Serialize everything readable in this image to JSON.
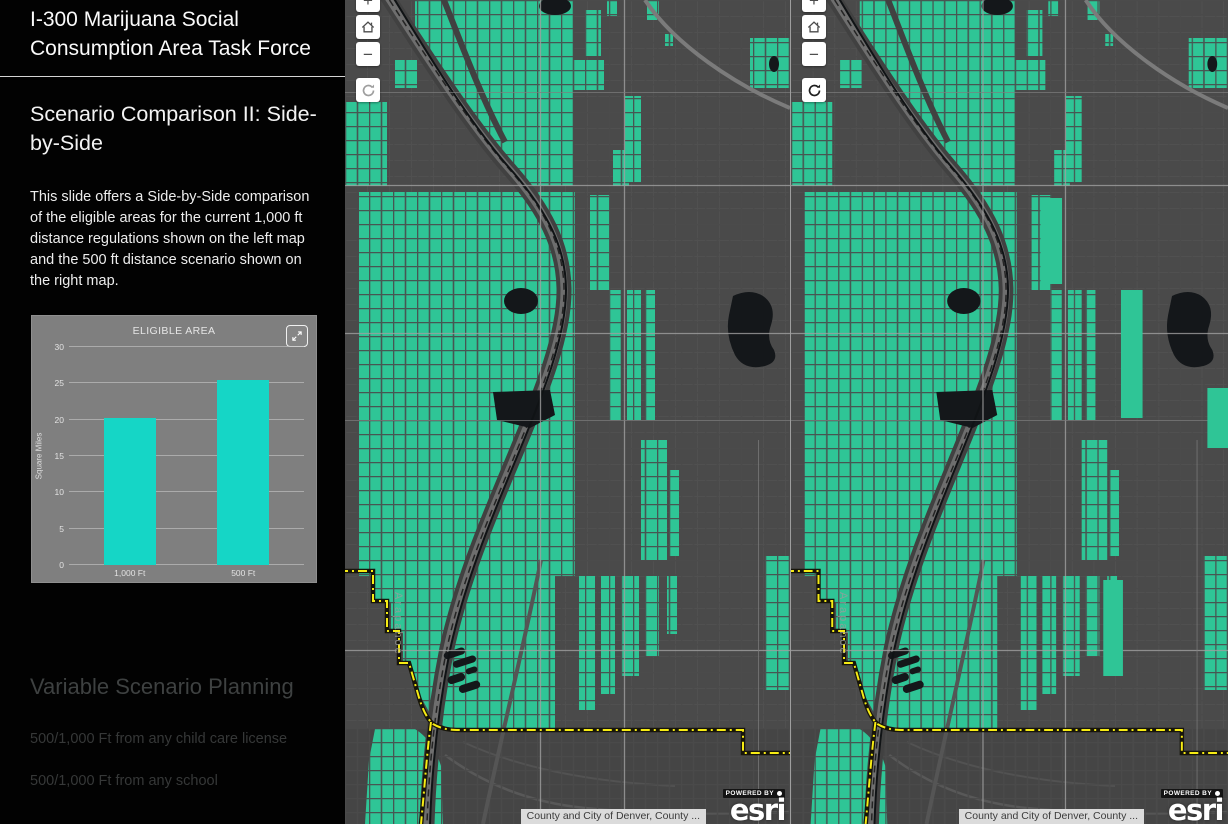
{
  "sidebar": {
    "title": "I-300 Marijuana Social Consumption Area Task Force",
    "slide_heading": "Scenario Comparison II: Side-by-Side",
    "description": "This slide offers a Side-by-Side comparison of the eligible areas for the current 1,000 ft distance regulations shown on the left map and the 500 ft distance scenario shown on the right map.",
    "next_heading": "Variable Scenario Planning",
    "next_items": [
      "500/1,000 Ft from any child care license",
      "500/1,000 Ft from any school"
    ]
  },
  "chart_data": {
    "type": "bar",
    "title": "ELIGIBLE AREA",
    "ylabel": "Square Miles",
    "xlabel": "",
    "categories": [
      "1,000 Ft",
      "500 Ft"
    ],
    "values": [
      20.2,
      25.4
    ],
    "ylim": [
      0,
      30
    ],
    "yticks": [
      0,
      5,
      10,
      15,
      20,
      25,
      30
    ],
    "grid": true,
    "legend_position": "none",
    "bar_color": "#15d6c6"
  },
  "map": {
    "street_label": "Arapahoe",
    "attribution": "County and City of Denver, County ...",
    "powered_by": "POWERED BY",
    "brand": "esri",
    "controls": {
      "zoom_in": "+",
      "zoom_out": "−"
    }
  },
  "colors": {
    "eligible_area": "#2fc596",
    "bar": "#15d6c6",
    "boundary_yellow": "#f7ec13",
    "map_background": "#4a4a4a",
    "chart_panel": "#7f7f7f"
  }
}
